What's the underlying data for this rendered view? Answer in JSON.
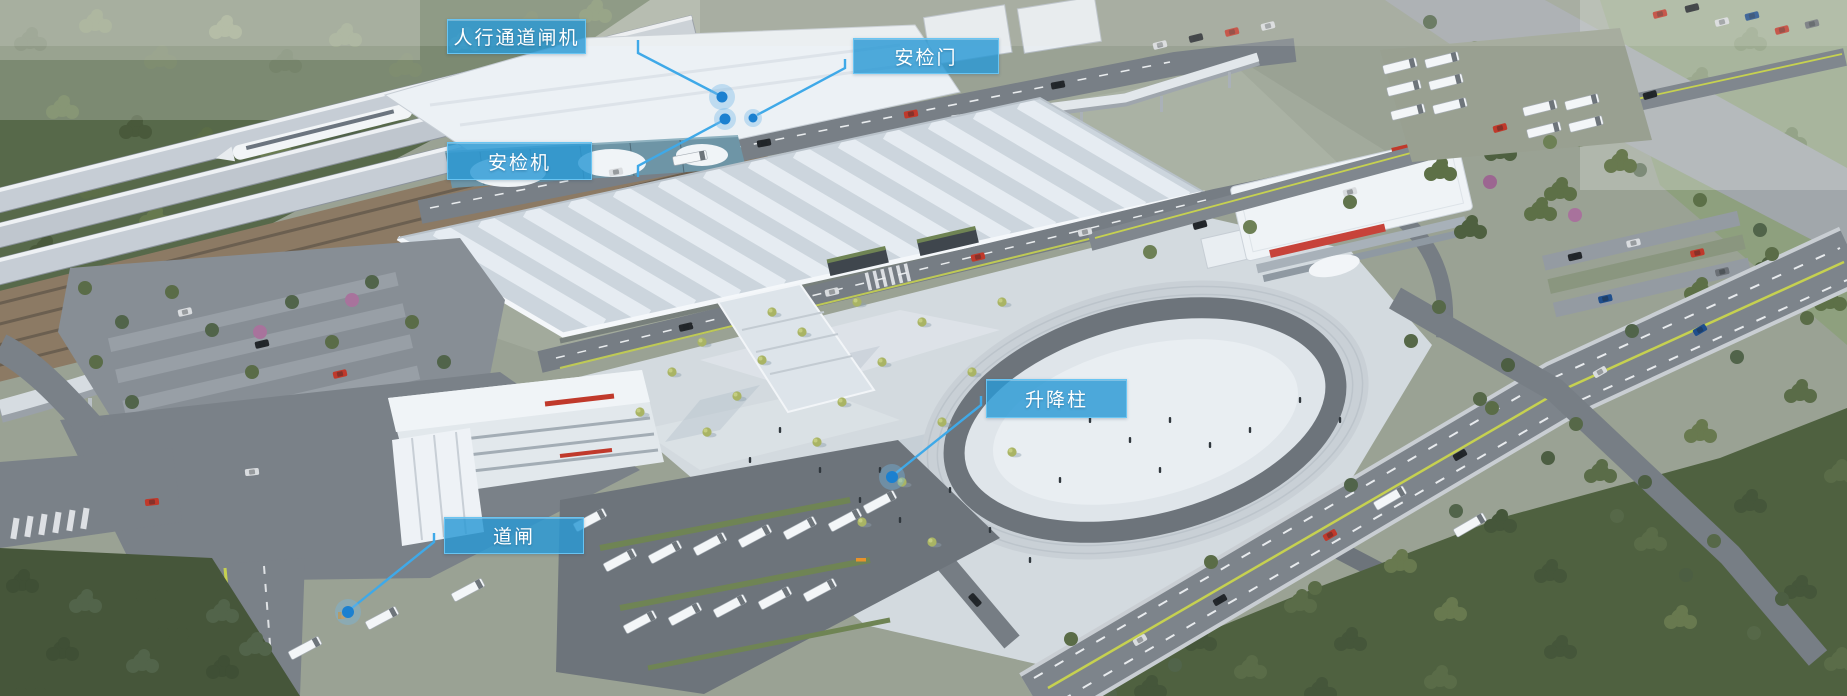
{
  "callouts": [
    {
      "id": "pedestrian-gate",
      "label": "人行通道闸机"
    },
    {
      "id": "security-door",
      "label": "安检门"
    },
    {
      "id": "security-scanner",
      "label": "安检机"
    },
    {
      "id": "lifting-bollard",
      "label": "升降柱"
    },
    {
      "id": "barrier-gate",
      "label": "道闸"
    }
  ],
  "colors": {
    "callout_fill": "rgba(42,153,212,0.82)",
    "callout_border": "#6cc6f3",
    "leader_line": "#3fa9e8",
    "marker_dot": "#1b80d0",
    "marker_halo": "#74b9e8"
  }
}
